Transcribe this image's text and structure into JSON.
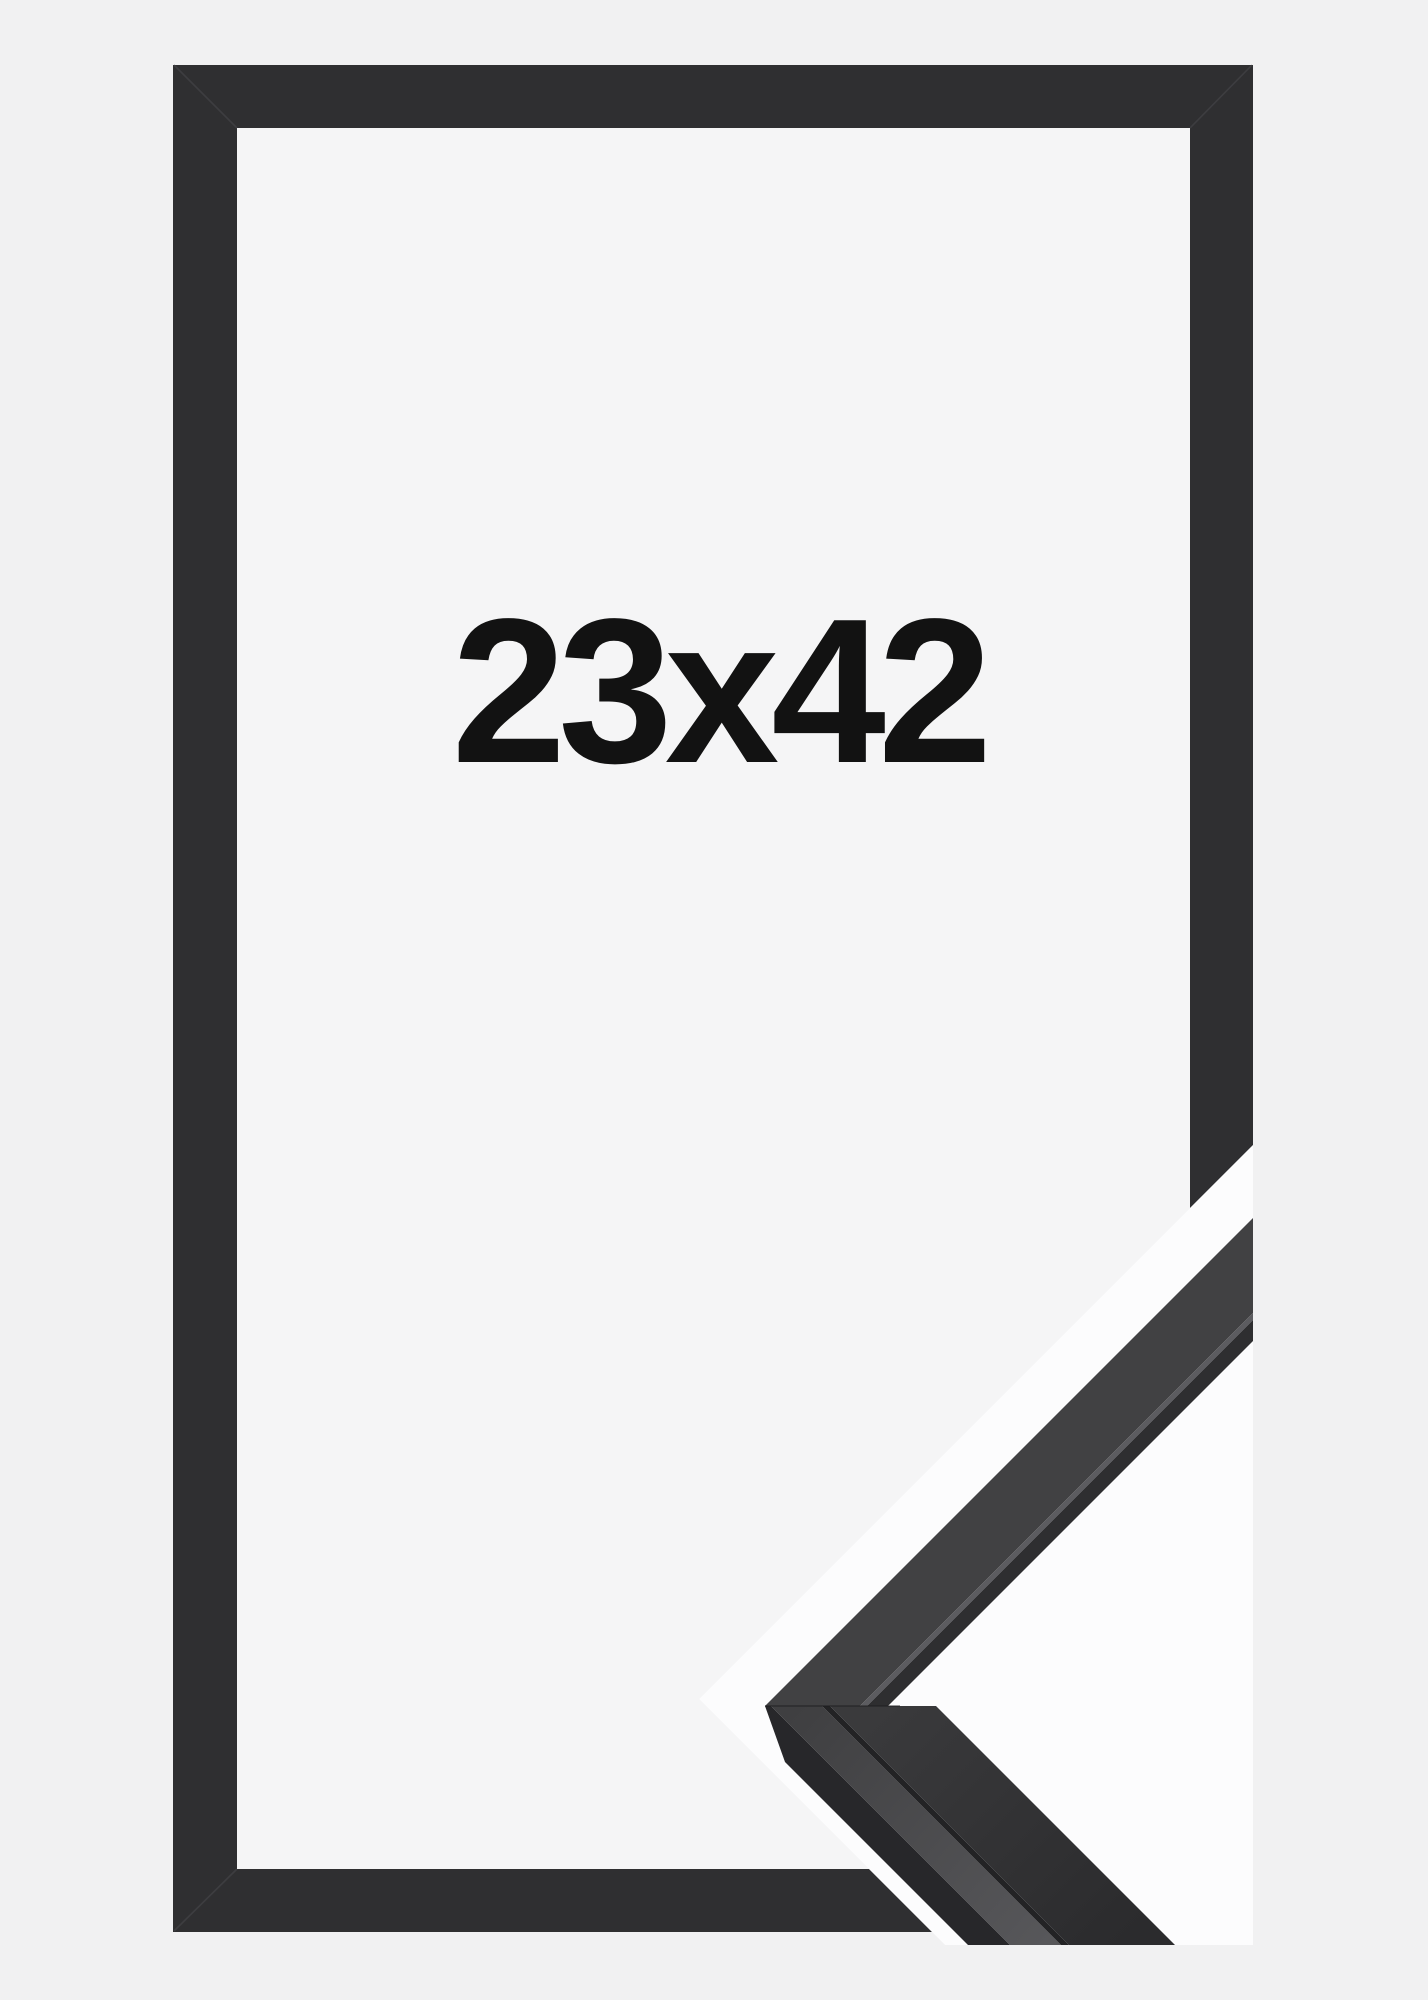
{
  "product_image": {
    "size_label": "23x42",
    "description": "black picture frame product photo with corner profile detail"
  },
  "colors": {
    "page_bg": "#f1f1f2",
    "opening_bg": "#f5f5f6",
    "frame_color": "#2f2f31",
    "frame_seam_color": "#4a4a4e",
    "text_color": "#121212",
    "detail_bg": "#fcfcfd",
    "detail_arm_front": "#414143",
    "detail_arm_arris": "#5c5c60",
    "detail_arm_sliver": "#2e2e30",
    "detail_outer_strip": "#27272a",
    "detail_top_face_light": "#57575a",
    "detail_top_face_dark": "#3f3f41",
    "detail_groove": "#232325",
    "detail_front_light": "#3a3a3c",
    "detail_front_dark": "#2b2b2d"
  }
}
